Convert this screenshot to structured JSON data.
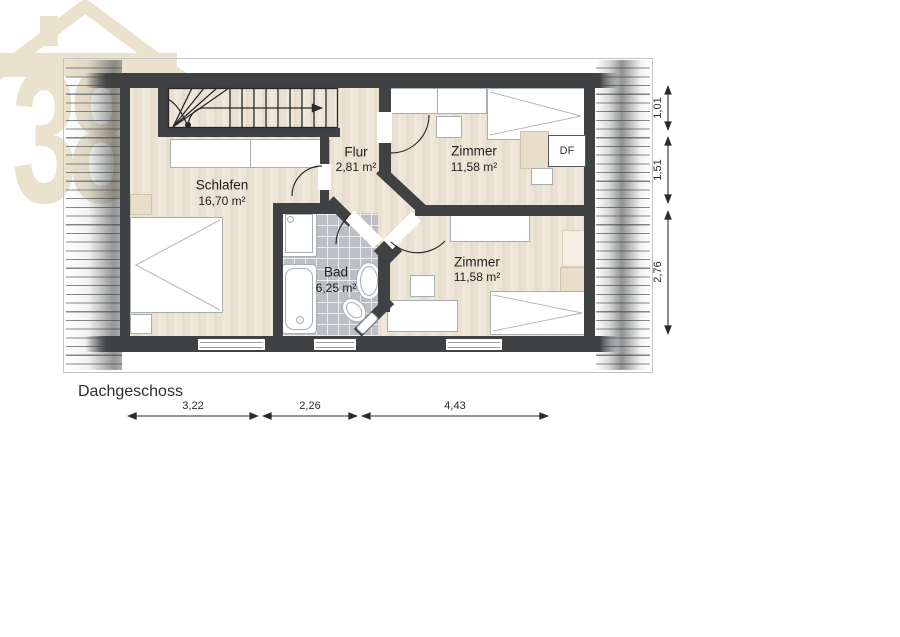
{
  "title": "Dachgeschoss",
  "watermark": {
    "number": "38"
  },
  "rooms": {
    "schlafen": {
      "name": "Schlafen",
      "area": "16,70 m²"
    },
    "flur": {
      "name": "Flur",
      "area": "2,81 m²"
    },
    "zimmer_top": {
      "name": "Zimmer",
      "area": "11,58 m²"
    },
    "bad": {
      "name": "Bad",
      "area": "6,25 m²"
    },
    "zimmer_bottom": {
      "name": "Zimmer",
      "area": "11,58 m²"
    }
  },
  "annotations": {
    "roof_window": "DF"
  },
  "dimensions": {
    "bottom": [
      "3,22",
      "2,26",
      "4,43"
    ],
    "right": [
      "1,01",
      "1,51",
      "2,76"
    ]
  },
  "colors": {
    "watermark_beige": "#EBE2CD",
    "wall": "#404143",
    "floor_wood": "#EAE2D4",
    "bath_tile": "#BCC0C4"
  }
}
